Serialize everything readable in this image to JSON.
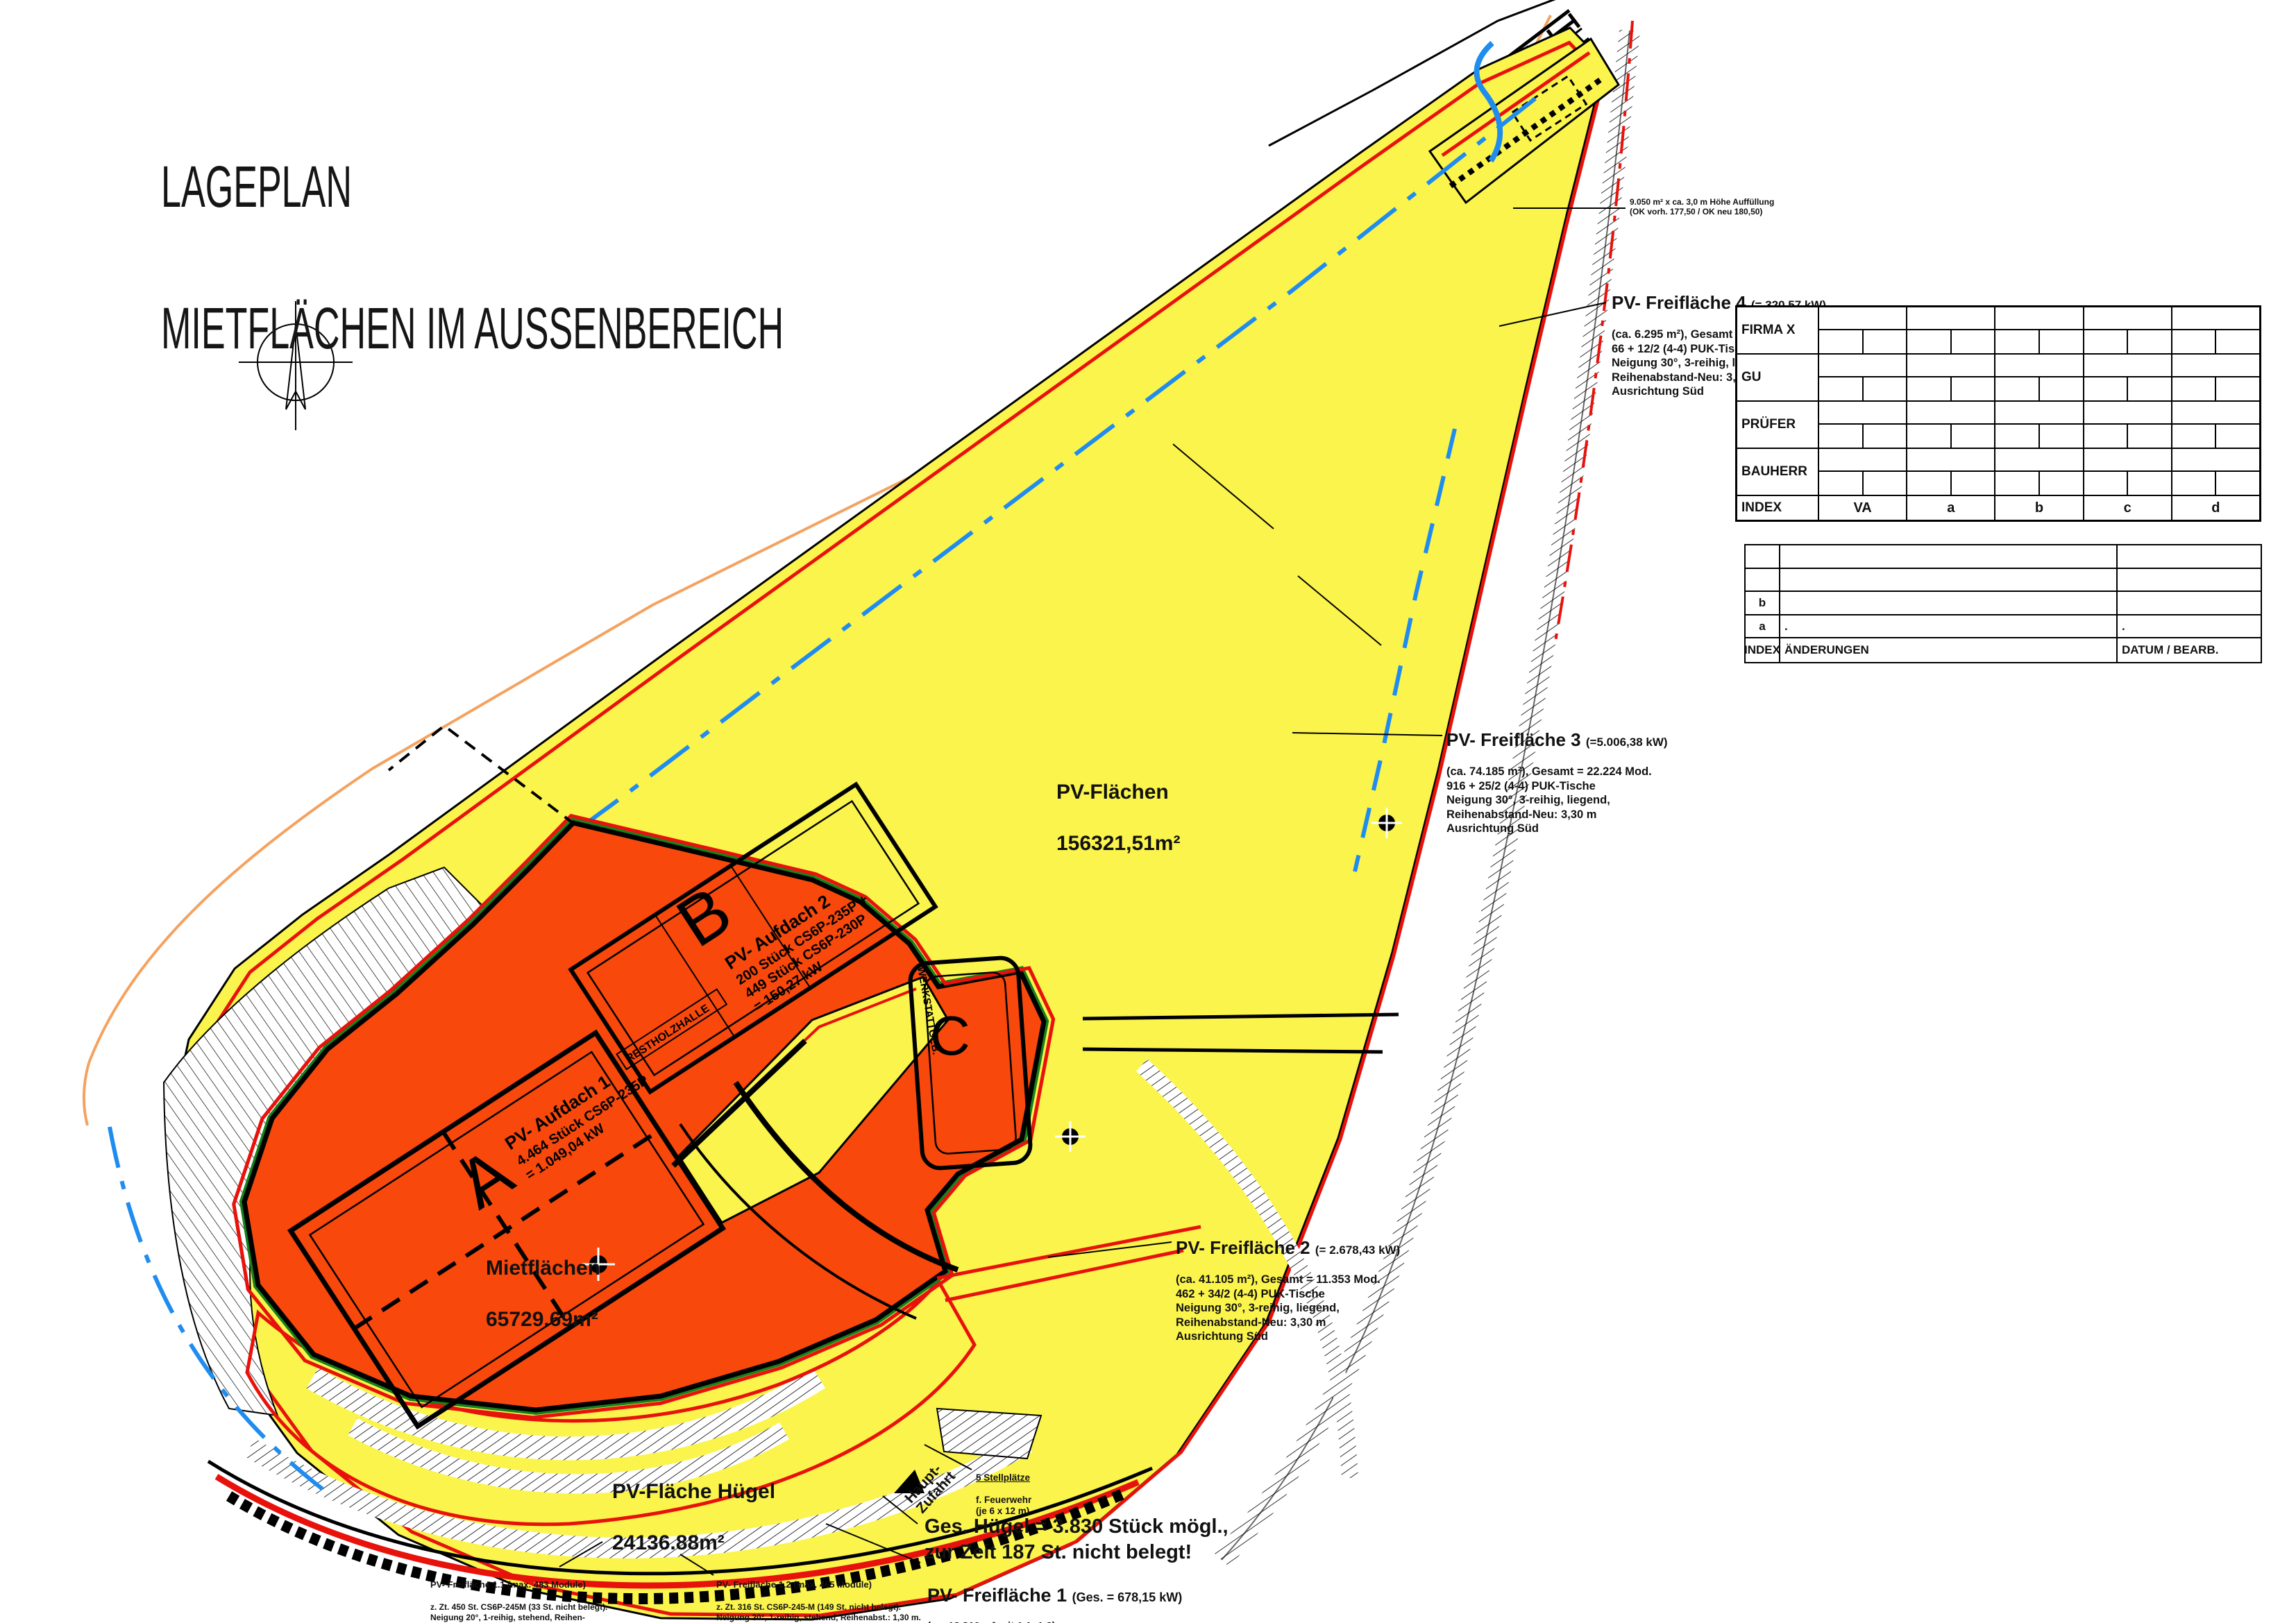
{
  "title": {
    "line1": "LAGEPLAN",
    "line2": "MIETFLÄCHEN IM AUSSENBEREICH"
  },
  "colors": {
    "yellow": "#FAF44C",
    "orange": "#F8480B",
    "red": "#E8120C",
    "blue": "#1F8CEF",
    "peach": "#F5A25F",
    "green": "#17801C"
  },
  "area_labels": {
    "pv_flaechen": {
      "name": "PV-Flächen",
      "area": "156321,51m²"
    },
    "mietflaechen": {
      "name": "Mietflächen",
      "area": "65729.69m²"
    },
    "huegel": {
      "name": "PV-Fläche Hügel",
      "area": "24136.88m²"
    }
  },
  "buildings": {
    "a": "A",
    "b": "B",
    "c": "C",
    "restholzhalle": "RESTHOLZHALLE",
    "werkstatt": "WERKSTATTGEB.",
    "aufdach1": {
      "lines": [
        "PV- Aufdach 1",
        "4.464 Stück CS6P-235P",
        "= 1.049,04 kW"
      ]
    },
    "aufdach2": {
      "lines": [
        "PV- Aufdach 2",
        "200 Stück CS6P-235P +",
        "449 Stück CS6P-230P",
        "= 150,27 kW"
      ]
    }
  },
  "annotations": {
    "pv4": {
      "head": "PV- Freifläche 4",
      "kw": "(= 320,57 kW)",
      "body": "(ca. 6.295 m²), Gesamt = 1.726 Module\n66 + 12/2 (4-4) PUK-Tische\nNeigung 30°, 3-reihig, liegend.\nReihenabstand-Neu: 3,30 m\nAusrichtung Süd"
    },
    "pv3": {
      "head": "PV- Freifläche 3",
      "kw": "(=5.006,38 kW)",
      "body": "(ca. 74.185 m²), Gesamt = 22.224 Mod.\n916 + 25/2 (4-4) PUK-Tische\nNeigung 30°, 3-reihig, liegend,\nReihenabstand-Neu: 3,30 m\nAusrichtung Süd"
    },
    "pv2": {
      "head": "PV- Freifläche 2",
      "kw": "(= 2.678,43 kW)",
      "body": "(ca. 41.105 m²), Gesamt = 11.353 Mod.\n462 + 34/2 (4-4) PUK-Tische\nNeigung 30°, 3-reihig, liegend,\nReihenabstand-Neu: 3,30 m\nAusrichtung Süd"
    },
    "huegel_note": "Ges. Hügel = 3.830 Stück mögl.,\nzur Zeit 187 St. nicht belegt!",
    "pv1": {
      "head": "PV- Freifläche 1",
      "kw": "(Ges. = 678,15 kW)",
      "body": "(ca. 13.810 m² mit 1.1+1.2)\n2.877 Stück CS6P-240-M (5 St. nicht belegt),\nNeigung 20°, 1-reihig, stehend,\nReihenabstand: 2,10 m\nAusrichtung Süd"
    },
    "pv11": {
      "head": "PV- Freifläche 1.1 (max. 483 Module)",
      "body": "z. Zt. 450 St. CS6P-245M (33 St. nicht belegt).\nNeigung 20°, 1-reihig, stehend, Reihen-\nabstand: 1,30 m. Ausrichtung Süd"
    },
    "pv12": {
      "head": "PV- Freifläche 1.2 (max. 465 Module)",
      "body": "z. Zt. 316 St. CS6P-245-M (149 St. nicht belegt).\nNeigung 20°, 1-reihig, stehend, Reihenabst.: 1,30 m.\nAusrichtung Süd-Ost (parallel zur Böschung)"
    },
    "auffuellung": "9.050 m² x ca. 3,0 m Höhe Auffüllung\n(OK vorh. 177,50 / OK neu 180,50)",
    "stellplaetze": {
      "l1": "5 Stellplätze",
      "rest": "f. Feuerwehr\n(je 6 x 12 m)"
    },
    "haupt_zufahrt": "Haupt-\nZufahrt"
  },
  "title_block": {
    "rows": [
      "FIRMA X",
      "GU",
      "PRÜFER",
      "BAUHERR"
    ],
    "index_row": {
      "label": "INDEX",
      "cols": [
        "VA",
        "a",
        "b",
        "c",
        "d"
      ]
    }
  },
  "revision_block": {
    "rows": [
      {
        "index": "",
        "change": "",
        "date": ""
      },
      {
        "index": "",
        "change": "",
        "date": ""
      },
      {
        "index": "b",
        "change": "",
        "date": ""
      },
      {
        "index": "a",
        "change": ".",
        "date": "."
      },
      {
        "index": "INDEX",
        "change": "ÄNDERUNGEN",
        "date": "DATUM / BEARB."
      }
    ]
  }
}
